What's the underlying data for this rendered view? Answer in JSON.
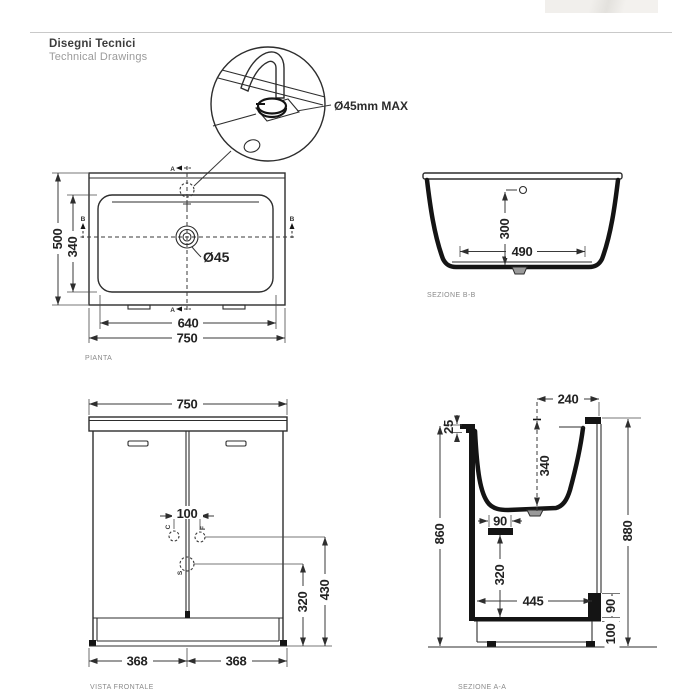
{
  "header": {
    "title_it": "Disegni Tecnici",
    "title_en": "Technical Drawings"
  },
  "detail": {
    "callout": "Ø45mm MAX"
  },
  "views": {
    "pianta": {
      "label": "PIANTA",
      "width_outer": "750",
      "width_inner": "640",
      "depth_outer": "500",
      "depth_inner": "340",
      "hole_diameter": "Ø45",
      "section_a": "A",
      "section_b": "B"
    },
    "sezione_bb": {
      "label": "SEZIONE B-B",
      "depth": "300",
      "width": "490"
    },
    "vista_frontale": {
      "label": "VISTA FRONTALE",
      "width_top": "750",
      "holes_spacing": "100",
      "door_left": "368",
      "door_right": "368",
      "tap_height": "430",
      "drain_height": "320",
      "letter_c": "C",
      "letter_f": "F",
      "letter_s": "S"
    },
    "sezione_aa": {
      "label": "SEZIONE A-A",
      "top_depth": "240",
      "rim": "25",
      "basin_depth": "340",
      "bracket_width": "90",
      "front_height": "860",
      "back_height": "880",
      "bracket_drop": "320",
      "bottom_depth": "445",
      "block_height": "90",
      "plinth_height": "100"
    }
  }
}
